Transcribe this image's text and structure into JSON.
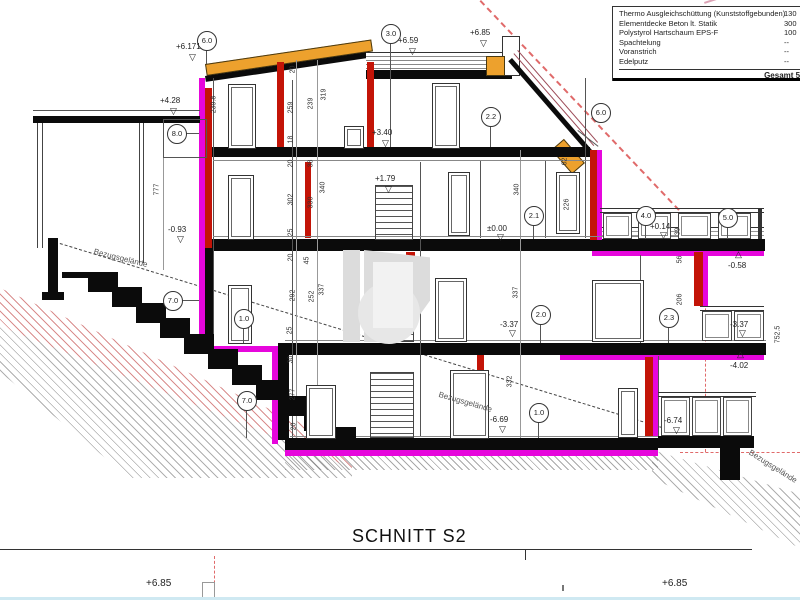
{
  "title": "SCHNITT S2",
  "footer": {
    "left_elevation": "+6.85",
    "right_elevation": "+6.85"
  },
  "materials_box": {
    "rows": [
      {
        "name": "Thermo Ausgleichschüttung (Kunststoffgebunden)",
        "value": "130"
      },
      {
        "name": "Elementdecke Beton lt. Statik",
        "value": "300"
      },
      {
        "name": "Polystyrol Hartschaum EPS-F",
        "value": "100"
      },
      {
        "name": "Spachtelung",
        "value": "--"
      },
      {
        "name": "Voranstrich",
        "value": "--"
      },
      {
        "name": "Edelputz",
        "value": "--"
      }
    ],
    "total": "Gesamt 560"
  },
  "grid_bubbles": [
    {
      "t": "6.0",
      "x": 206,
      "y": 40
    },
    {
      "t": "3.0",
      "x": 390,
      "y": 33
    },
    {
      "t": "6.0",
      "x": 600,
      "y": 112
    },
    {
      "t": "8.0",
      "x": 176,
      "y": 133
    },
    {
      "t": "2.2",
      "x": 490,
      "y": 116
    },
    {
      "t": "2.1",
      "x": 533,
      "y": 215
    },
    {
      "t": "4.0",
      "x": 645,
      "y": 215
    },
    {
      "t": "5.0",
      "x": 727,
      "y": 217
    },
    {
      "t": "7.0",
      "x": 172,
      "y": 300
    },
    {
      "t": "1.0",
      "x": 243,
      "y": 318
    },
    {
      "t": "2.0",
      "x": 540,
      "y": 314
    },
    {
      "t": "2.3",
      "x": 668,
      "y": 317
    },
    {
      "t": "7.0",
      "x": 246,
      "y": 400
    },
    {
      "t": "1.0",
      "x": 538,
      "y": 412
    }
  ],
  "elevations": [
    {
      "t": "+6.171",
      "x": 176,
      "y": 42,
      "md": "d",
      "mx": 189,
      "my": 53
    },
    {
      "t": "+4.28",
      "x": 160,
      "y": 96,
      "md": "d",
      "mx": 170,
      "my": 107
    },
    {
      "t": "+6.59",
      "x": 398,
      "y": 36,
      "md": "d",
      "mx": 409,
      "my": 47
    },
    {
      "t": "+6.85",
      "x": 470,
      "y": 28,
      "md": "d",
      "mx": 480,
      "my": 39
    },
    {
      "t": "+3.40",
      "x": 372,
      "y": 128,
      "md": "d",
      "mx": 382,
      "my": 139
    },
    {
      "t": "+1.79",
      "x": 375,
      "y": 174,
      "md": "d",
      "mx": 385,
      "my": 185
    },
    {
      "t": "±0.00",
      "x": 487,
      "y": 224,
      "md": "d",
      "mx": 497,
      "my": 233
    },
    {
      "t": "+0.14",
      "x": 650,
      "y": 222,
      "md": "d",
      "mx": 660,
      "my": 231
    },
    {
      "t": "-0.58",
      "x": 728,
      "y": 261,
      "md": "u",
      "mx": 735,
      "my": 250
    },
    {
      "t": "-0.93",
      "x": 168,
      "y": 225,
      "md": "d",
      "mx": 177,
      "my": 235
    },
    {
      "t": "-3.37",
      "x": 500,
      "y": 320,
      "md": "d",
      "mx": 509,
      "my": 329
    },
    {
      "t": "-3.37",
      "x": 730,
      "y": 320,
      "md": "d",
      "mx": 739,
      "my": 329
    },
    {
      "t": "-4.02",
      "x": 730,
      "y": 361,
      "md": "u",
      "mx": 737,
      "my": 350
    },
    {
      "t": "-6.69",
      "x": 490,
      "y": 415,
      "md": "d",
      "mx": 499,
      "my": 425
    },
    {
      "t": "-6.74",
      "x": 664,
      "y": 416,
      "md": "d",
      "mx": 673,
      "my": 426
    }
  ],
  "dimensions": [
    {
      "t": "239.8",
      "x": 214,
      "y": 105
    },
    {
      "t": "777",
      "x": 157,
      "y": 190
    },
    {
      "t": "752.5",
      "x": 778,
      "y": 335
    },
    {
      "t": "20",
      "x": 293,
      "y": 70
    },
    {
      "t": "259",
      "x": 291,
      "y": 108
    },
    {
      "t": "239",
      "x": 311,
      "y": 104
    },
    {
      "t": "319",
      "x": 324,
      "y": 95
    },
    {
      "t": "18",
      "x": 291,
      "y": 140
    },
    {
      "t": "20",
      "x": 291,
      "y": 164
    },
    {
      "t": "38",
      "x": 311,
      "y": 164
    },
    {
      "t": "302",
      "x": 291,
      "y": 200
    },
    {
      "t": "330",
      "x": 311,
      "y": 203
    },
    {
      "t": "340",
      "x": 323,
      "y": 188
    },
    {
      "t": "25",
      "x": 291,
      "y": 233
    },
    {
      "t": "340",
      "x": 517,
      "y": 190
    },
    {
      "t": "62",
      "x": 565,
      "y": 162
    },
    {
      "t": "226",
      "x": 567,
      "y": 205
    },
    {
      "t": "20",
      "x": 291,
      "y": 258
    },
    {
      "t": "45",
      "x": 307,
      "y": 261
    },
    {
      "t": "292",
      "x": 293,
      "y": 296
    },
    {
      "t": "252",
      "x": 312,
      "y": 297
    },
    {
      "t": "337",
      "x": 322,
      "y": 290
    },
    {
      "t": "337",
      "x": 516,
      "y": 293
    },
    {
      "t": "25",
      "x": 290,
      "y": 331
    },
    {
      "t": "30",
      "x": 291,
      "y": 360
    },
    {
      "t": "277",
      "x": 293,
      "y": 395
    },
    {
      "t": "332",
      "x": 510,
      "y": 382
    },
    {
      "t": "20",
      "x": 294,
      "y": 427
    },
    {
      "t": "206",
      "x": 680,
      "y": 300
    },
    {
      "t": "56",
      "x": 680,
      "y": 260
    },
    {
      "t": "39",
      "x": 678,
      "y": 232
    }
  ],
  "terrain_labels": [
    {
      "t": "Bezugsgelände",
      "x": 95,
      "y": 247,
      "a": 14
    },
    {
      "t": "Bezugsgelände",
      "x": 440,
      "y": 390,
      "a": 16
    },
    {
      "t": "Bezugsgelände",
      "x": 752,
      "y": 448,
      "a": 32
    }
  ]
}
